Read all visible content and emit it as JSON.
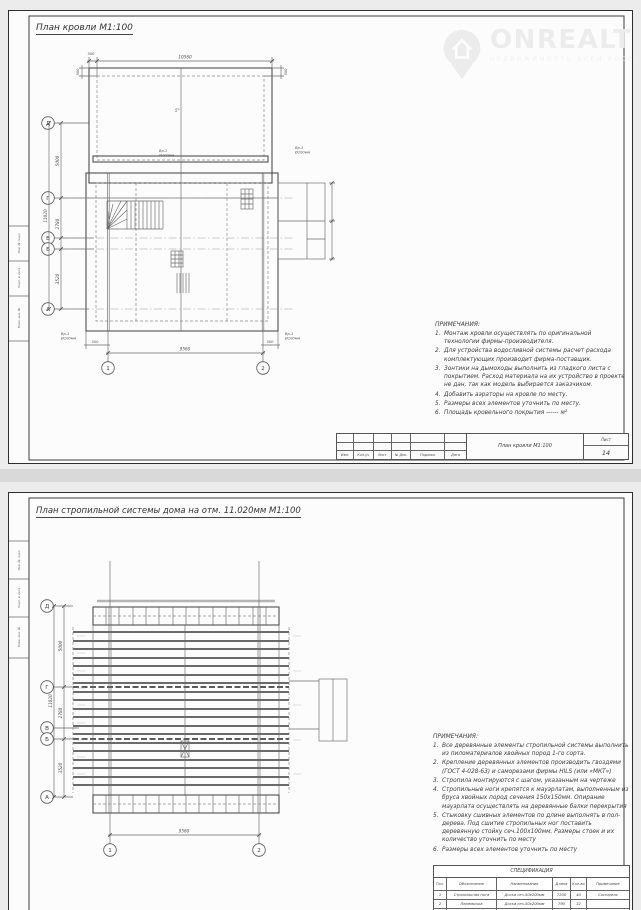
{
  "page": {
    "background": "#ececec",
    "paper": "#fcfcfc",
    "divider": "#d9d9d9"
  },
  "watermark": {
    "brand": "ONREALT",
    "tagline": "НЕДВИЖИМОСТЬ ВСЕЙ РОССИИ",
    "color": "#ececec",
    "icon": "house-pin-icon"
  },
  "stamp_side": {
    "labels": [
      "Инв. № подл.",
      "Подп. и дата",
      "Взам. инв. №"
    ]
  },
  "sheet1": {
    "title": "План кровли М1:100",
    "drawing": {
      "axes_rows": [
        "Д",
        "Г",
        "В",
        "Б",
        "А"
      ],
      "axes_cols": [
        "1",
        "2"
      ],
      "dim_top_total": "10560",
      "dim_eave": "500",
      "dim_bottom": "9560",
      "dim_left_total": "11020",
      "dim_left_seg1": "5000",
      "dim_left_seg2": "2780",
      "dim_left_seg3": "3520",
      "slope": "5°",
      "funnel_label": "Вр-1",
      "funnel_size": "Ø100мм"
    },
    "notes": {
      "heading": "ПРИМЕЧАНИЯ:",
      "items": [
        {
          "n": "1.",
          "text": "Монтаж кровли осуществлять по оригинальной технологии фирмы-производителя."
        },
        {
          "n": "2.",
          "text": "Для устройства водосливной системы расчет расхода комплектующих производит фирма-поставщик."
        },
        {
          "n": "3.",
          "text": "Зонтики на дымоходы выполнить из гладкого листа с покрытием. Расход материала на их устройство в проекте не дан, так как модель выбирается заказчиком."
        },
        {
          "n": "4.",
          "text": "Добавить аэраторы на кровле по месту."
        },
        {
          "n": "5.",
          "text": "Размеры всех элементов уточнить по месту."
        },
        {
          "n": "6.",
          "text": "Площадь кровельного покрытия ------ м²"
        }
      ]
    },
    "titleblock": {
      "labels": [
        "Изм.",
        "Кол.уч",
        "Лист",
        "№ Док.",
        "Подпись",
        "Дата"
      ],
      "doc_title": "План кровли М1:100",
      "sheet_word": "Лист",
      "sheet_num": "14"
    }
  },
  "sheet2": {
    "title": "План стропильной системы дома на отм. 11.020мм М1:100",
    "drawing": {
      "axes_rows": [
        "Д",
        "Г",
        "В",
        "Б",
        "А"
      ],
      "axes_cols": [
        "1",
        "2"
      ],
      "dim_bottom": "9560",
      "dim_left_total": "11020",
      "dim_left_seg1": "5000",
      "dim_left_seg2": "2780",
      "dim_left_seg3": "3520"
    },
    "notes": {
      "heading": "ПРИМЕЧАНИЯ:",
      "items": [
        {
          "n": "1.",
          "text": "Все деревянные элементы стропильной системы выполнить из пиломатериалов хвойных пород 1-го сорта."
        },
        {
          "n": "2.",
          "text": "Крепление деревянных элементов производить гвоздями (ГОСТ 4-028-63) и саморезами фирмы HILS (или «МКТ»)"
        },
        {
          "n": "3.",
          "text": "Стропила монтируются с шагом, указанным на чертеже"
        },
        {
          "n": "4.",
          "text": "Стропильные ноги крепятся к мауэрлатам, выполненным из бруса хвойных пород сечения 150х150мм. Опирание мауэрлата осуществлять на деревянные балки перекрытия"
        },
        {
          "n": "5.",
          "text": "Стыковку сшивных элементов по длине выполнять в пол-дерева. Под сшитие стропильных ног поставить деревянную стойку сеч.100х100мм. Размеры стоек и их количество уточнить по месту"
        },
        {
          "n": "6.",
          "text": "Размеры всех элементов уточнить по месту"
        }
      ]
    },
    "spec": {
      "title": "СПЕЦИФИКАЦИЯ",
      "columns": [
        "Поз.",
        "Обозначение",
        "Наименование",
        "Длина",
        "Кол-во",
        "Примечание"
      ],
      "rows": [
        [
          "1",
          "Стропильная нога",
          "Доска сеч.50х200мм",
          "7200",
          "40",
          "Сосна/ель"
        ],
        [
          "2",
          "Перемычка",
          "Доска сеч.50х200мм",
          "790",
          "32",
          ""
        ],
        [
          "3",
          "",
          "",
          "",
          "",
          ""
        ]
      ]
    }
  }
}
